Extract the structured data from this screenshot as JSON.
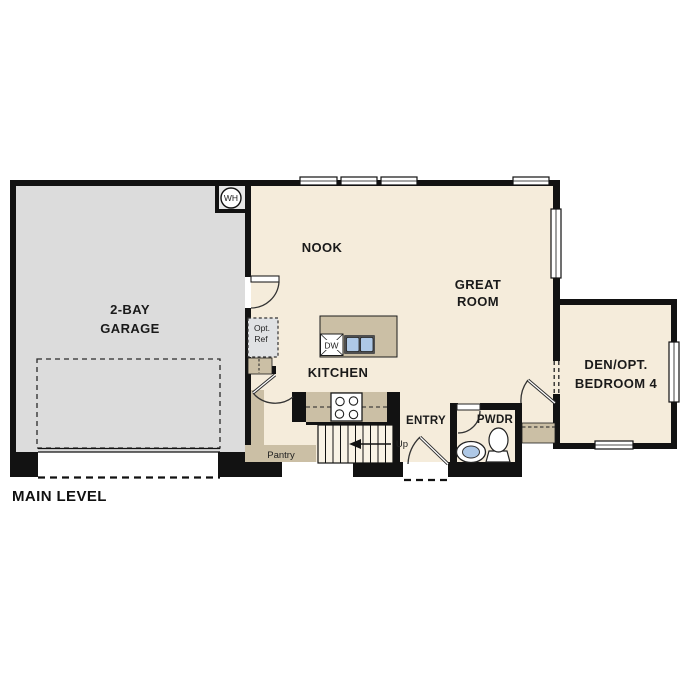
{
  "plan": {
    "title": "MAIN LEVEL",
    "colors": {
      "wall": "#121212",
      "floor": "#f5ecdb",
      "garage_floor": "#dcdcdc",
      "casework_tan": "#cbbfa5",
      "sink_blue": "#aec8e6",
      "optional_gray": "#e0e2e4"
    },
    "rooms": {
      "garage": {
        "line1": "2-BAY",
        "line2": "GARAGE"
      },
      "nook": {
        "label": "NOOK"
      },
      "great_room": {
        "line1": "GREAT",
        "line2": "ROOM"
      },
      "kitchen": {
        "label": "KITCHEN"
      },
      "entry": {
        "label": "ENTRY"
      },
      "powder": {
        "label": "PWDR"
      },
      "den": {
        "line1": "DEN/OPT.",
        "line2": "BEDROOM 4"
      },
      "pantry": {
        "label": "Pantry"
      }
    },
    "annotations": {
      "water_heater": "WH",
      "dishwasher": "DW",
      "optional_fridge_line1": "Opt.",
      "optional_fridge_line2": "Ref",
      "stairs_direction": "Up"
    }
  }
}
